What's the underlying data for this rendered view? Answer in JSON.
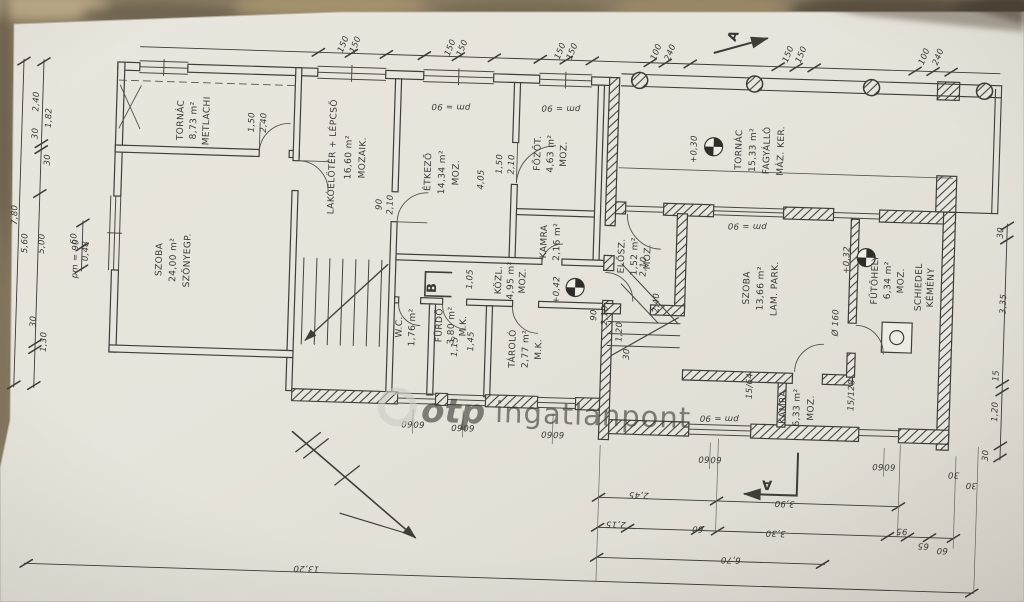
{
  "rooms": {
    "tornac_old": [
      "TORNÁC",
      "8,73 m²",
      "METLACHI"
    ],
    "szoba_old": [
      "SZOBA",
      "24,00 m²",
      "SZŐNYEGP."
    ],
    "lakoeloter": [
      "LAKÓELŐTÉR + LÉPCSŐ",
      "16,60 m²",
      "MOZAIK."
    ],
    "etkezo": [
      "ÉTKEZŐ",
      "14,34 m²",
      "MOZ."
    ],
    "fozot": [
      "FŐZŐT.",
      "4,63 m²",
      "MOZ."
    ],
    "kamra_kis": [
      "KAMRA",
      "2,16 m²"
    ],
    "wc": [
      "W.C.",
      "1,76 m²"
    ],
    "furdo": [
      "FÜRDŐ",
      "3,80 m²",
      "M.K."
    ],
    "kozl": [
      "KÖZL.",
      "4,95 m²",
      "MOZ."
    ],
    "tarolo": [
      "TÁROLÓ",
      "2,77 m²",
      "M.K."
    ],
    "elosz": [
      "ELŐSZ.",
      "1,52 m²",
      "MOZ."
    ],
    "tornac_uj": [
      "TORNÁC",
      "15,33 m²",
      "FAGYÁLLÓ",
      "MÁZ. KER."
    ],
    "szoba_uj": [
      "SZOBA",
      "13,66 m²",
      "LAM. PARK."
    ],
    "kamra_nagy": [
      "KAMRA",
      "6,33 m²",
      "MOZ."
    ],
    "futohely": [
      "FŰTŐHELY",
      "6,34 m²",
      "MOZ."
    ],
    "kemeny": [
      "SCHIEDEL",
      "KÉMÉNY"
    ]
  },
  "levels": {
    "porch": "+0,30",
    "room": "+0,32",
    "hall": "+0,42"
  },
  "annotations": {
    "pm": "pm = 90",
    "dia": "Ø 160",
    "st64": "15/64",
    "st128": "15/128",
    "sec": "A",
    "mb": "B"
  },
  "dims": {
    "top": [
      "150",
      "150",
      "150",
      "150",
      "150",
      "150",
      "100",
      "240",
      "150",
      "150",
      "100",
      "240"
    ],
    "left": [
      "7,80",
      "2,40",
      "30",
      "1,82",
      "30",
      "5,60",
      "5,00",
      "30",
      "1,30",
      "60",
      "0,48"
    ],
    "right": [
      "30",
      "3,35",
      "15",
      "1,20",
      "30"
    ],
    "b1": [
      "2,45",
      "3,90"
    ],
    "b2": [
      "2,15",
      "60",
      "3,30",
      "95",
      "65",
      "60"
    ],
    "b3": [
      "6,70"
    ],
    "b4": [
      "13,20",
      "3,28"
    ],
    "c30": [
      "30",
      "30"
    ],
    "wp": [
      "60",
      "60",
      "60",
      "60",
      "60",
      "60",
      "60",
      "60",
      "60",
      "60"
    ],
    "inner": [
      "4,05",
      "1,05",
      "1,45",
      "1,15",
      "2,10",
      "2,40",
      "1,20",
      "30"
    ],
    "doors": [
      "1,50",
      "2,40",
      "90",
      "2,10",
      "1,50",
      "2,10",
      "90",
      "2,10"
    ]
  },
  "watermark": {
    "brand": "otp",
    "name": "ingatlanpont"
  }
}
